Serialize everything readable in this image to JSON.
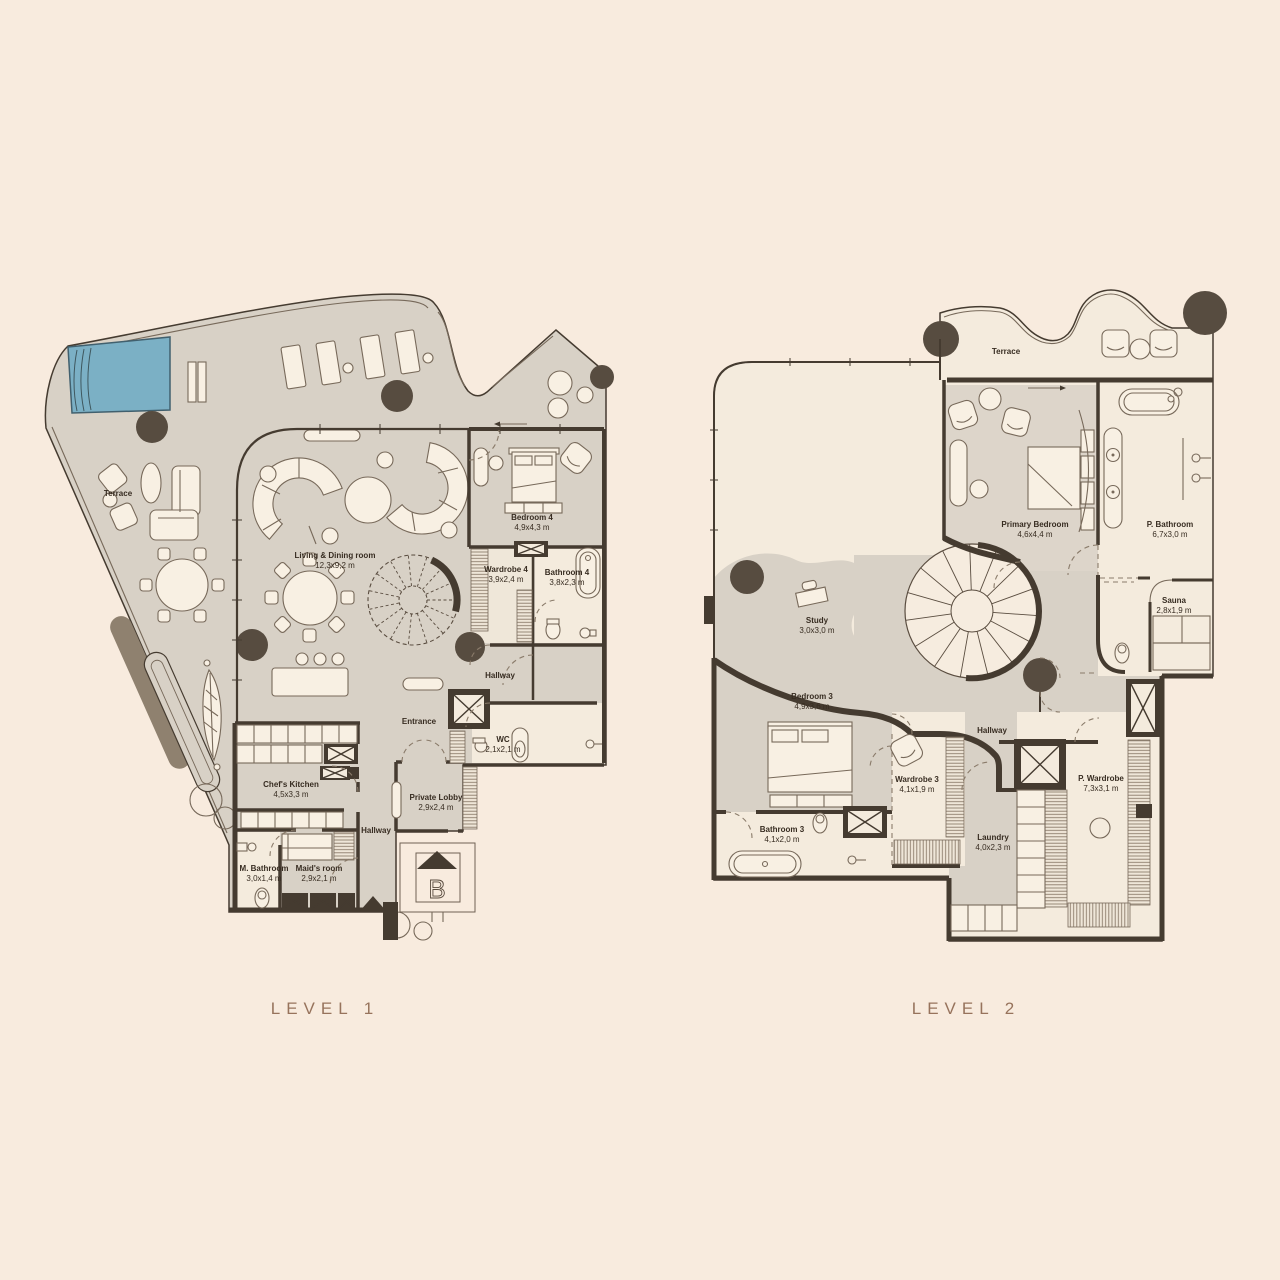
{
  "colors": {
    "background": "#f8ebde",
    "floor_gray": "#d8d1c6",
    "floor_cream": "#f4ebdd",
    "wall": "#453b30",
    "pool": "#7bb0c5",
    "title": "#97735c",
    "column": "#574c40"
  },
  "titles": {
    "level1": "LEVEL 1",
    "level2": "LEVEL 2"
  },
  "level1": {
    "marker_letter": "B",
    "rooms": [
      {
        "label": "Terrace",
        "dims": ""
      },
      {
        "label": "Living & Dining room",
        "dims": "12,3x9,2 m"
      },
      {
        "label": "Bedroom 4",
        "dims": "4,9x4,3 m"
      },
      {
        "label": "Wardrobe 4",
        "dims": "3,9x2,4 m"
      },
      {
        "label": "Bathroom 4",
        "dims": "3,8x2,3 m"
      },
      {
        "label": "Hallway",
        "dims": ""
      },
      {
        "label": "Entrance",
        "dims": ""
      },
      {
        "label": "WC",
        "dims": "2,1x2,1 m"
      },
      {
        "label": "Chef's Kitchen",
        "dims": "4,5x3,3 m"
      },
      {
        "label": "Private Lobby",
        "dims": "2,9x2,4 m"
      },
      {
        "label": "Hallway",
        "dims": ""
      },
      {
        "label": "Maid's room",
        "dims": "2,9x2,1 m"
      },
      {
        "label": "M. Bathroom",
        "dims": "3,0x1,4 m"
      }
    ]
  },
  "level2": {
    "rooms": [
      {
        "label": "Terrace",
        "dims": ""
      },
      {
        "label": "Primary Bedroom",
        "dims": "4,6x4,4 m"
      },
      {
        "label": "P. Bathroom",
        "dims": "6,7x3,0 m"
      },
      {
        "label": "Sauna",
        "dims": "2,8x1,9 m"
      },
      {
        "label": "Study",
        "dims": "3,0x3,0 m"
      },
      {
        "label": "Bedroom 3",
        "dims": "4,9x3,6 m"
      },
      {
        "label": "Wardrobe 3",
        "dims": "4,1x1,9 m"
      },
      {
        "label": "Hallway",
        "dims": ""
      },
      {
        "label": "Bathroom 3",
        "dims": "4,1x2,0 m"
      },
      {
        "label": "Laundry",
        "dims": "4,0x2,3 m"
      },
      {
        "label": "P. Wardrobe",
        "dims": "7,3x3,1 m"
      }
    ]
  }
}
